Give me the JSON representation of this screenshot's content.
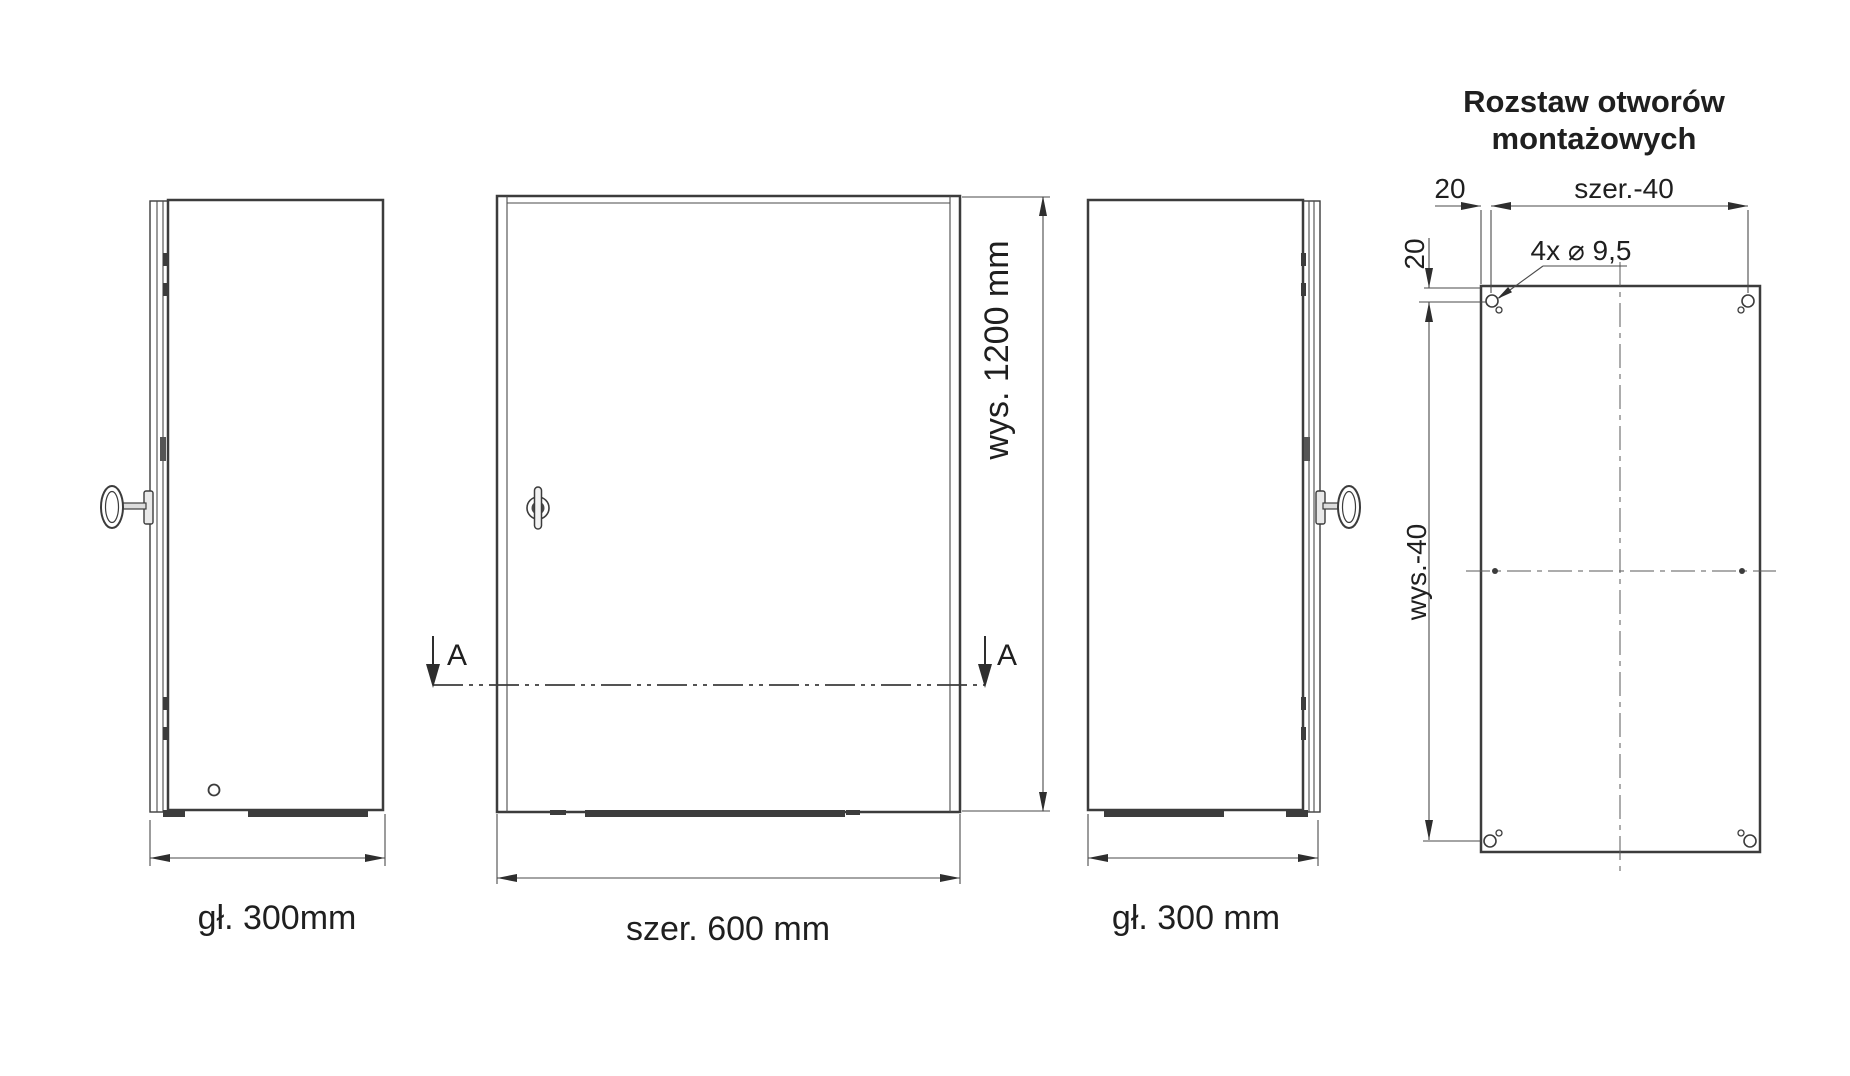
{
  "title": {
    "line1": "Rozstaw otworów",
    "line2": "montażowych"
  },
  "labels": {
    "left_depth": "gł. 300mm",
    "front_width": "szer. 600 mm",
    "front_height": "wys. 1200 mm",
    "right_depth": "gł. 300 mm",
    "section_marker": "A"
  },
  "mounting": {
    "offset_top": "20",
    "offset_left": "20",
    "width_spacing": "szer.-40",
    "height_spacing": "wys.-40",
    "holes_callout": "4x ⌀ 9,5"
  },
  "colors": {
    "title": "#a22735",
    "line": "#3c3c3c"
  }
}
